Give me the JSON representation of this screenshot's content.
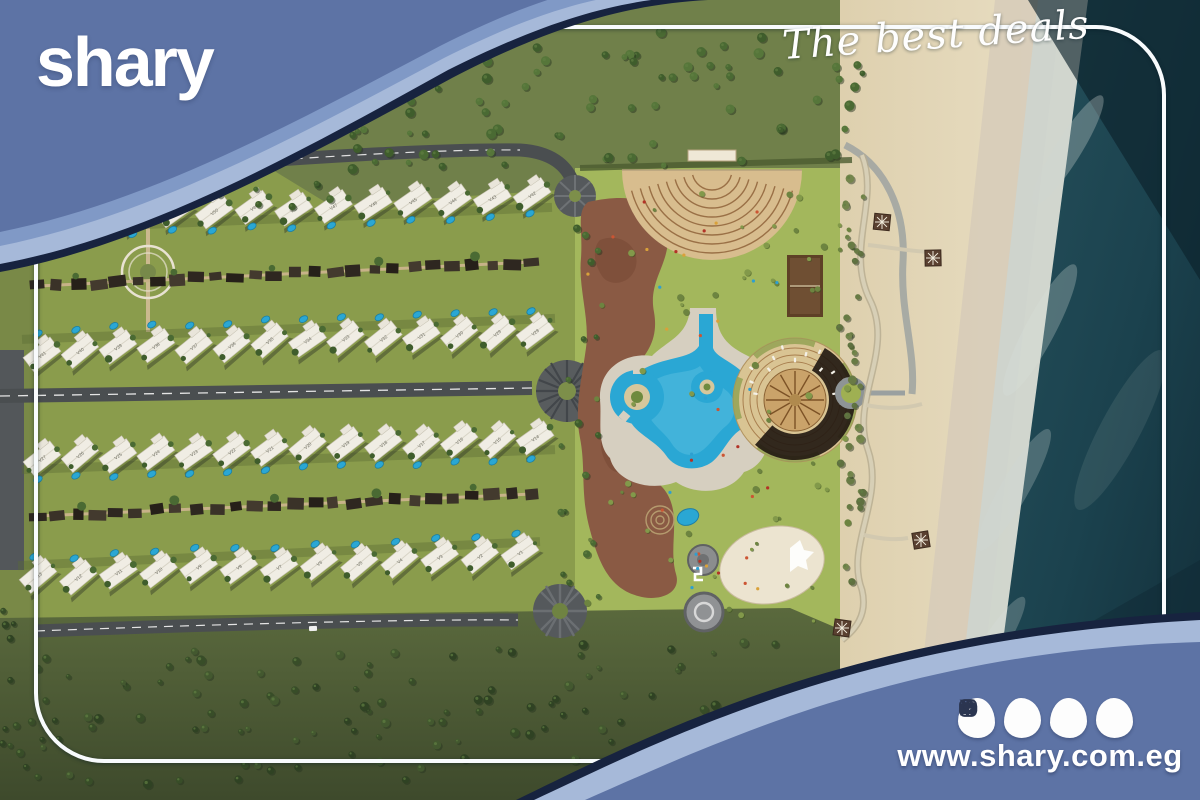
{
  "brand": {
    "logo": "shary",
    "tagline": "The best deals",
    "website": "www.shary.com.eg"
  },
  "social": [
    {
      "name": "instagram"
    },
    {
      "name": "x"
    },
    {
      "name": "youtube"
    },
    {
      "name": "facebook"
    }
  ],
  "map": {
    "description": "Beachfront resort master plan, top view",
    "villa_rows": [
      {
        "labels": [
          "V53",
          "V52",
          "V51",
          "V50",
          "V49",
          "V48",
          "V47",
          "V46",
          "V45",
          "V44",
          "V43",
          "V42"
        ]
      },
      {
        "labels": [
          "V41",
          "V40",
          "V39",
          "V38",
          "V37",
          "V36",
          "V35",
          "V34",
          "V33",
          "V32",
          "V31",
          "V30",
          "V29",
          "V28"
        ]
      },
      {
        "labels": [
          "V27",
          "V26",
          "V25",
          "V24",
          "V23",
          "V22",
          "V21",
          "V20",
          "V19",
          "V18",
          "V17",
          "V16",
          "V15",
          "V14"
        ]
      },
      {
        "labels": [
          "V13",
          "V12",
          "V11",
          "V10",
          "V9",
          "V8",
          "V7",
          "V6",
          "V5",
          "V4",
          "V3",
          "V2",
          "V1"
        ]
      }
    ],
    "colors": {
      "banner_main": "#5d73a5",
      "banner_mid": "#8099c6",
      "banner_light": "#a6b9d9",
      "banner_edge": "#17233f",
      "frame_line": "#f8fbfd",
      "lawn": "#93a84e",
      "lawn_light": "#a3b75c",
      "forest_ground": "#6e7e45",
      "road": "#4a4e50",
      "pool_blue": "#2aa7d4",
      "plaza_brown": "#8a5a44",
      "sand": "#e6dabb",
      "ocean": "#1a3e4a",
      "villa_white": "#f0ede4"
    }
  }
}
